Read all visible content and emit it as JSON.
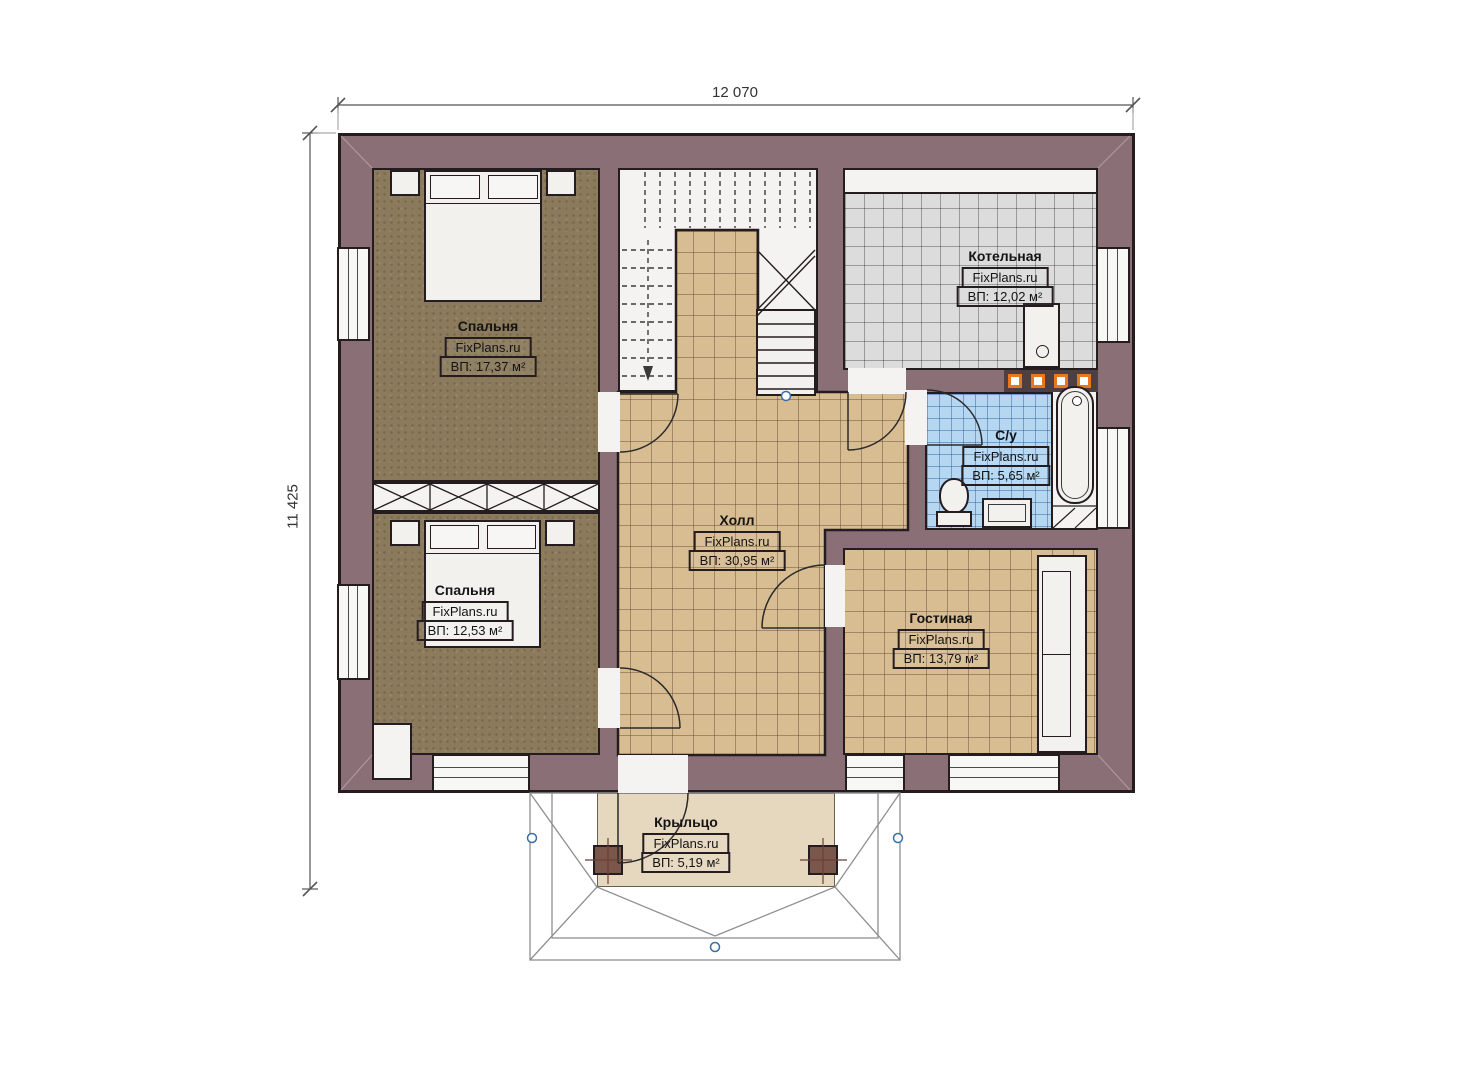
{
  "watermark": "FixPlans.ru",
  "dimensions": {
    "width_label": "12 070",
    "height_label": "11 425"
  },
  "rooms": {
    "bedroom1": {
      "name": "Спальня",
      "area": "ВП: 17,37 м²"
    },
    "bedroom2": {
      "name": "Спальня",
      "area": "ВП: 12,53 м²"
    },
    "hall": {
      "name": "Холл",
      "area": "ВП: 30,95 м²"
    },
    "boiler": {
      "name": "Котельная",
      "area": "ВП: 12,02 м²"
    },
    "bathroom": {
      "name": "С/у",
      "area": "ВП: 5,65 м²"
    },
    "living": {
      "name": "Гостиная",
      "area": "ВП: 13,79 м²"
    },
    "porch": {
      "name": "Крыльцо",
      "area": "ВП: 5,19 м²"
    }
  },
  "colors": {
    "wall": "#8a7076",
    "bedroom_floor": "#8b7a5c",
    "tile_tan": "#d8bd93",
    "tile_gray": "#dcdcdc",
    "tile_blue": "#b6d7f2",
    "porch_floor": "#e6d7bf",
    "accent_orange": "#e8781c",
    "marker_blue": "#3a6ea5"
  }
}
